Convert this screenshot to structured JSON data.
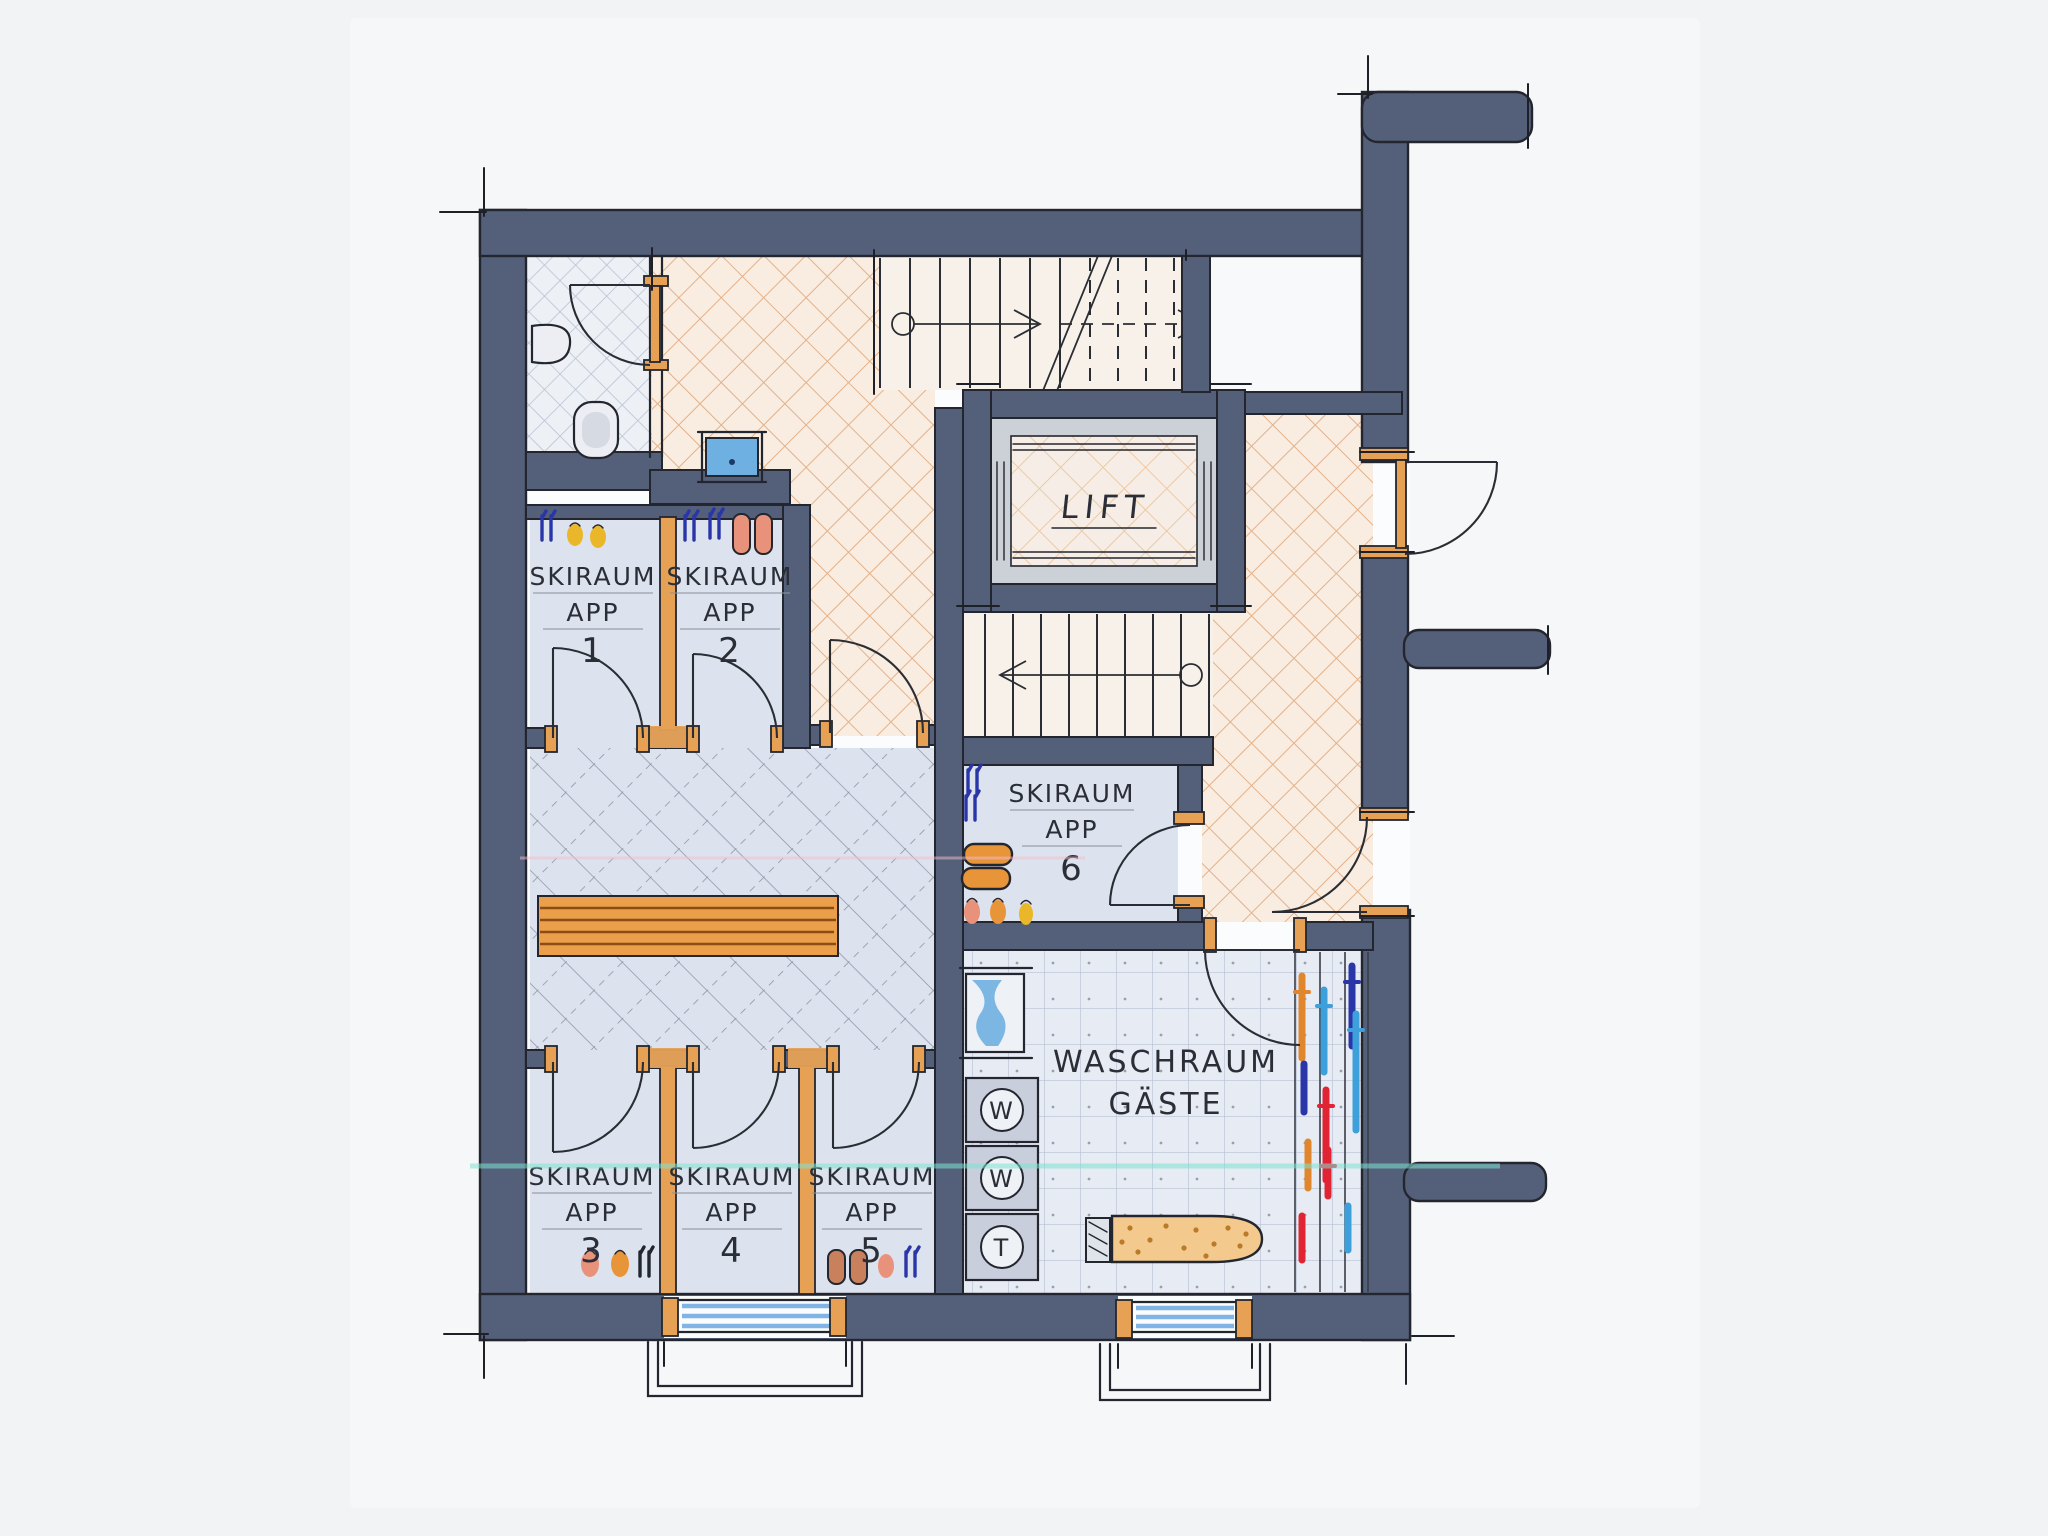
{
  "plan": {
    "rooms": [
      {
        "id": "skiraum-app-1",
        "line1": "SKIRAUM",
        "line2": "APP",
        "number": "1"
      },
      {
        "id": "skiraum-app-2",
        "line1": "SKIRAUM",
        "line2": "APP",
        "number": "2"
      },
      {
        "id": "skiraum-app-3",
        "line1": "SKIRAUM",
        "line2": "APP",
        "number": "3"
      },
      {
        "id": "skiraum-app-4",
        "line1": "SKIRAUM",
        "line2": "APP",
        "number": "4"
      },
      {
        "id": "skiraum-app-5",
        "line1": "SKIRAUM",
        "line2": "APP",
        "number": "5"
      },
      {
        "id": "skiraum-app-6",
        "line1": "SKIRAUM",
        "line2": "APP",
        "number": "6"
      }
    ],
    "lift": {
      "label": "LIFT"
    },
    "laundry": {
      "line1": "WASCHRAUM",
      "line2": "GÄSTE",
      "machines": [
        {
          "letter": "W"
        },
        {
          "letter": "W"
        },
        {
          "letter": "T"
        }
      ]
    }
  },
  "colors": {
    "wall": "#54607a",
    "wood": "#e6a155",
    "ink": "#23262e",
    "tile_orange_bg": "#f9ece0",
    "tile_orange_line": "#e3b28a",
    "tile_blue_bg": "#edf0f5",
    "tile_blue_line": "#b7c1d2",
    "room_bg": "#dde3ee",
    "hatch_line": "#8d97a9",
    "laundry_bg": "#e7ebf3",
    "laundry_grid": "#b9c3d6",
    "stair_bg": "#f8f1ea",
    "glass": "#7fb4e4",
    "water": "#6fb0e2",
    "highlight_cyan": "#7fe3d2",
    "highlight_pink": "#f2bccb",
    "ski_orange": "#e0872e",
    "ski_blue_light": "#3da0da",
    "ski_blue_dark": "#2a35a8",
    "ski_red": "#e02434",
    "boot_yellow": "#eab62a",
    "boot_salmon": "#e8927c",
    "boot_orange": "#e8953a",
    "boot_brown": "#c9805c",
    "bench": "#eb9f4a"
  }
}
